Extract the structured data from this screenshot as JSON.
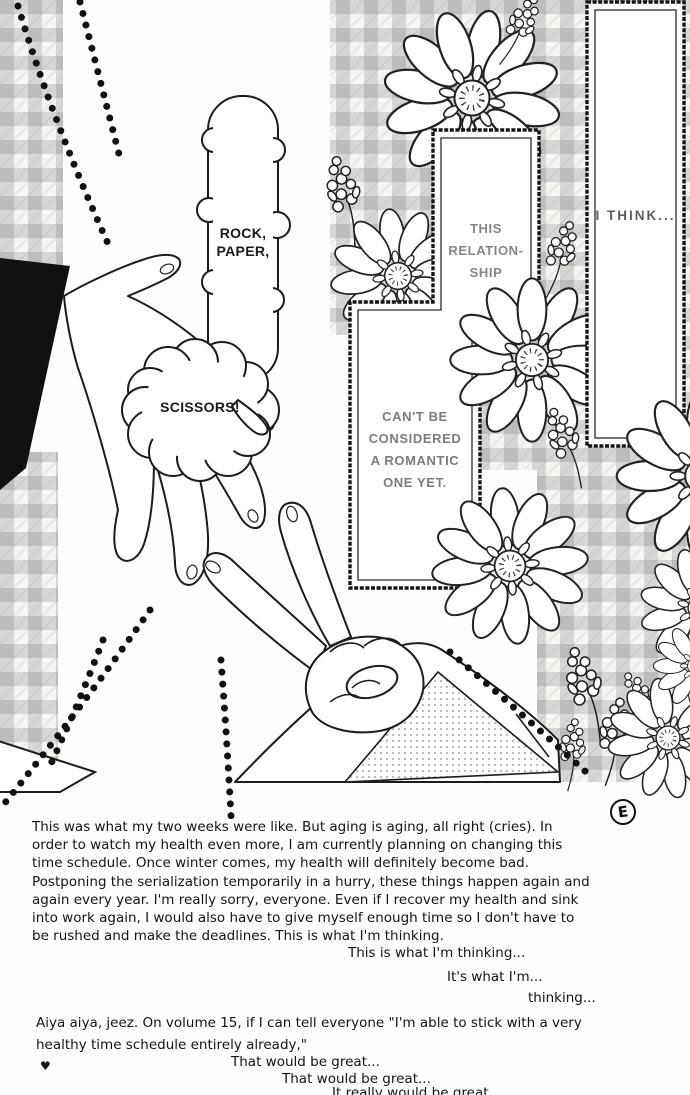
{
  "artwork": {
    "speech": {
      "rock": "ROCK,",
      "paper": "PAPER,",
      "scissors": "SCISSORS!"
    },
    "caption_boxes": {
      "relationship": {
        "line1": "THIS",
        "line2": "RELATION-",
        "line3": "SHIP"
      },
      "cant_be": {
        "line1": "CAN'T BE",
        "line2": "CONSIDERED",
        "line3": "A ROMANTIC",
        "line4": "ONE YET."
      },
      "i_think": {
        "line1": "I THINK..."
      }
    }
  },
  "notes": {
    "page_mark": "E",
    "para1": {
      "l1": "This was what my two weeks were like. But aging is aging, all right (cries). In",
      "l2": "order to watch my health even more, I am currently planning on changing this",
      "l3": "time schedule. Once winter comes, my health will definitely become bad.",
      "l4": "Postponing the serialization temporarily in a hurry, these things happen again and",
      "l5": "again every year. I'm really sorry, everyone. Even if I recover my health and sink",
      "l6": "into work again, I would also have to give myself enough time so I don't have to",
      "l7": "be rushed and make the deadlines. This is what I'm thinking."
    },
    "echo1": "This is what I'm thinking...",
    "echo2": "It's what I'm...",
    "echo3": "thinking...",
    "para2": {
      "l1": "Aiya aiya, jeez. On volume 15, if I can tell everyone \"I'm able to stick with a very",
      "l2": "healthy time schedule entirely already,\""
    },
    "heart": "♥",
    "great1": "That would be great...",
    "great2": "That would be great...",
    "great3": "It really would be great..."
  },
  "colors": {
    "ink": "#1c1c1c",
    "caption_text": "#7c7c7c",
    "gingham_check": "#c9c7c2"
  }
}
